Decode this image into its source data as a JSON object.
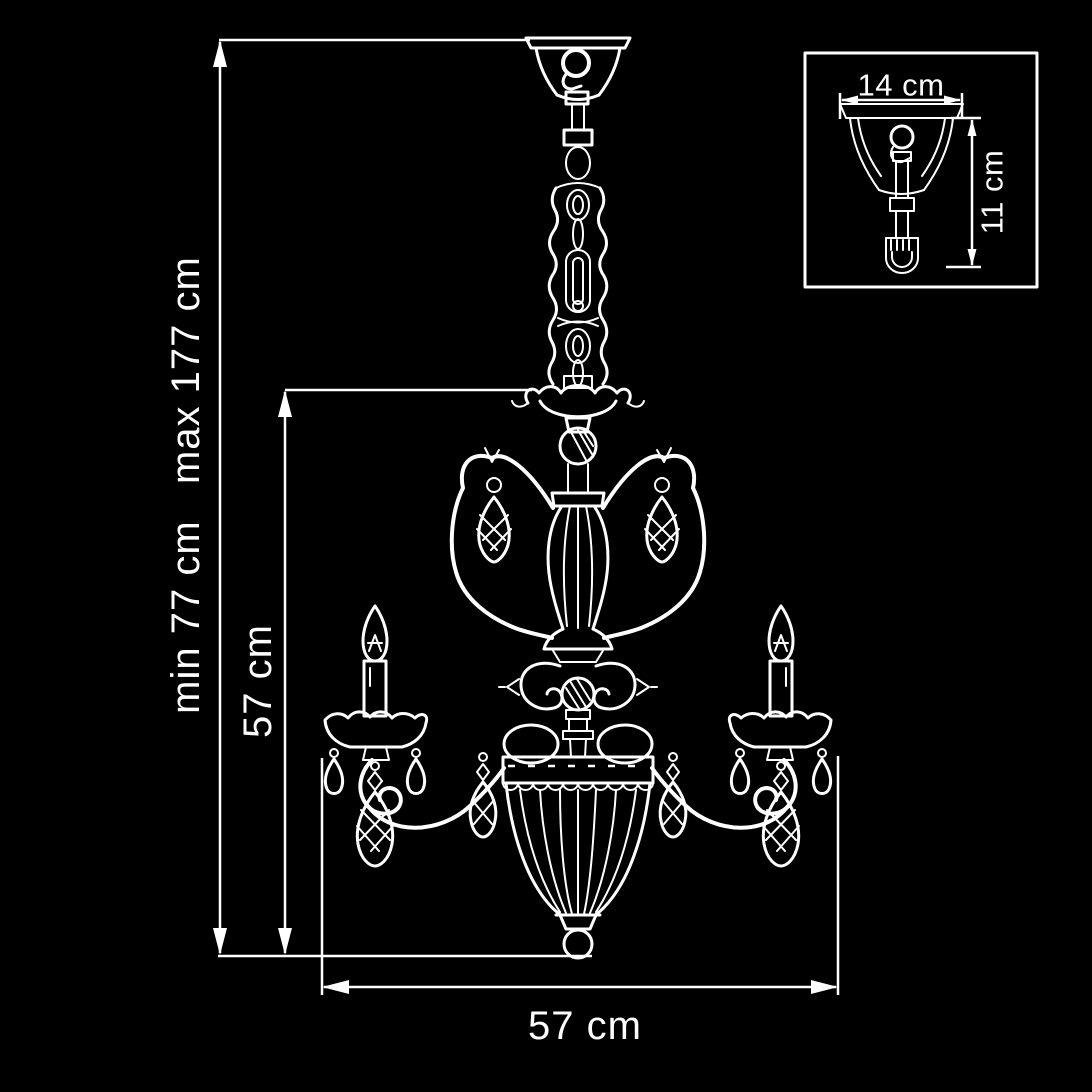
{
  "canvas": {
    "background_color": "#000000",
    "line_color": "#ffffff",
    "subject": "chandelier dimensional line drawing"
  },
  "labels": {
    "height_range": "min 77 cm   max 177 cm",
    "fixture_height": "57 cm",
    "fixture_width": "57 cm",
    "inset_canopy_width": "14 cm",
    "inset_canopy_height": "11 cm"
  }
}
